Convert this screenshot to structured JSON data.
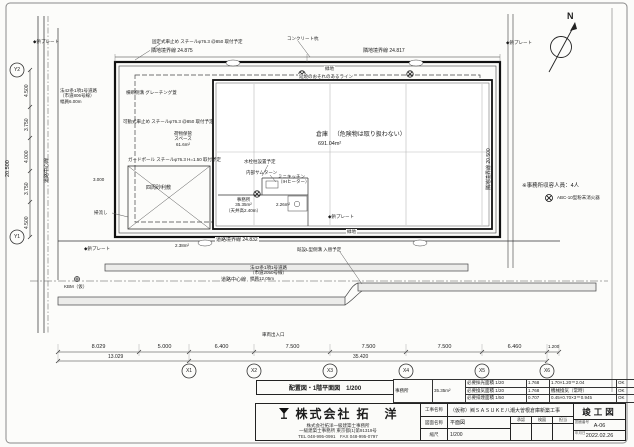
{
  "north_label": "N",
  "caption": "配置図・1階平面図　1/200",
  "notes": {
    "capacity": "※事務所収容人員：4人",
    "extinguisher": "ABC-10型粉末消火器"
  },
  "sheet": {
    "stamp": "竣工図",
    "drawing_no": "A-06",
    "date": "2022.02.26",
    "project_name": "（仮称）㈱ＳＡＳＵＫＥ八潮大曽根倉庫新築工事",
    "drawing_name": "平面図",
    "scale": "1/200",
    "labels": {
      "project": "工事名称",
      "drawing": "図面名称",
      "scale": "縮尺",
      "number": "図面番号",
      "date": "年月日",
      "approve": "承認",
      "check": "検図",
      "charge": "担当"
    },
    "company": {
      "name": "株式会社 拓　洋",
      "lines": [
        "株式会社拓洋一級建築士事務所",
        "一級建築士事務所 東京都(1)第91319号",
        "TEL 048-995-0991　FAX 048-995-0797"
      ]
    }
  },
  "compliance": {
    "room": "事務所",
    "room_area": "35.35m²",
    "rows": [
      {
        "item": "必要採光面積 1/20",
        "req": "1.768",
        "actual": "1.70×1.20＝2.04",
        "judge": "OK"
      },
      {
        "item": "必要換気面積 1/20",
        "req": "1.768",
        "actual": "機械換気（常時）",
        "judge": "OK"
      },
      {
        "item": "必要排煙面積 1/50",
        "req": "0.707",
        "actual": "0.45×0.70×3＝0.945",
        "judge": "OK"
      }
    ]
  },
  "rooms": {
    "warehouse": {
      "name": "倉庫",
      "note": "（危険物は取り扱わない）",
      "area": "691.04m²"
    },
    "office": {
      "name": "事務所",
      "area": "35.35m²",
      "ceiling": "（天井高2.40m）"
    },
    "kitchen": {
      "l1": "ミニキッチン",
      "l2": "（IHヒーター）"
    },
    "toilet_area": "2.26m²",
    "storage": {
      "l1": "荷物保管",
      "l2": "スペース",
      "l3": "61.6m²"
    },
    "gravel": "四周砂利敷"
  },
  "boundaries": {
    "top_left": "隣地境界線 24.875",
    "top_right": "隣地境界線 24.817",
    "right_v": "隣地境界線 20.500",
    "road": "道路境界線 24.832",
    "center": "道路中心線",
    "road_south": {
      "l1": "法42条1項1号道路",
      "l2": "（市道2050号線）",
      "l3": "幅員12.05m"
    },
    "road_west": {
      "l1": "法42条1項1号道路",
      "l2": "（市道806号線）",
      "l3": "幅員6.00m"
    }
  },
  "annotations": {
    "car_stop_fixed": "固定式車止め スチールφ76.3 @850 取付予定",
    "car_stop_movable": "可動式車止め スチールφ76.3 @850 取付予定",
    "guard_pole": "ガードポール スチールφ76.3 H=1.50 取付予定",
    "grating": "横断側溝 グレーチング蓋",
    "concrete_pile": "コンクリート杭",
    "fire_line": "延焼のおそれのあるライン",
    "green": "緑地",
    "pin_plate": "◆鋲プレート",
    "kbm": "KBM（仮）",
    "water_tap": "水栓柱設置予定",
    "thumbturn": "内部サムターン",
    "slop_sink": "掃流し",
    "gutter_replace": "既設L型側溝 入替予定",
    "vehicle_entrance": "車両出入口",
    "corner_area": "2.38m²"
  },
  "dims": {
    "bottom": [
      "8.029",
      "5.000",
      "6.400",
      "7.500",
      "7.500",
      "7.500",
      "6.460",
      "1.200"
    ],
    "bottom_totals": [
      "13.029",
      "35.420"
    ],
    "left": [
      "4.500",
      "3.750",
      "4.000",
      "3.750",
      "4.500"
    ],
    "left_total": "20.500",
    "misc_3000": "3.000"
  },
  "grid": {
    "x": [
      "X1",
      "X2",
      "X3",
      "X4",
      "X5",
      "X6"
    ],
    "y1": "Y1",
    "y2": "Y2"
  }
}
